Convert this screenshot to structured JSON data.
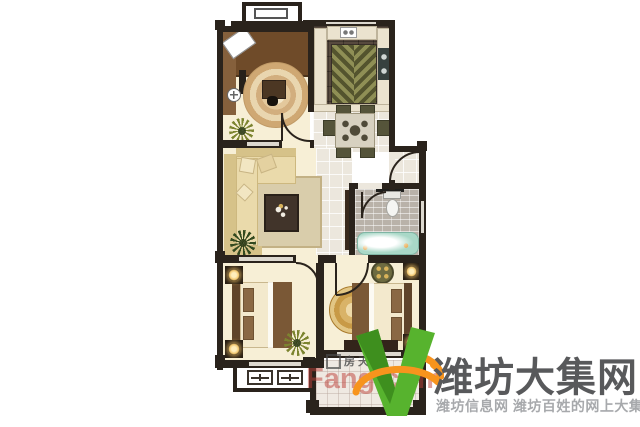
{
  "page": {
    "background": "#ffffff",
    "width": 640,
    "height": 427
  },
  "floorplan": {
    "type": "apartment-floor-plan",
    "rooms": [
      {
        "name": "study",
        "furniture": [
          "wardrobe-desk",
          "drafting-board",
          "round-rug",
          "computer-desk",
          "potted-plant"
        ]
      },
      {
        "name": "kitchen",
        "furniture": [
          "counters",
          "stove",
          "sink",
          "chevron-rug"
        ]
      },
      {
        "name": "dining-area",
        "furniture": [
          "dining-table",
          "dining-chairs"
        ]
      },
      {
        "name": "entry-hall",
        "furniture": []
      },
      {
        "name": "living-room",
        "furniture": [
          "corner-sofa",
          "coffee-table",
          "area-rug",
          "tv-cabinet",
          "potted-plant"
        ]
      },
      {
        "name": "bathroom",
        "furniture": [
          "toilet",
          "bathtub",
          "cabinet"
        ]
      },
      {
        "name": "bedroom-left",
        "furniture": [
          "double-bed",
          "nightstands",
          "lamps",
          "potted-plant"
        ]
      },
      {
        "name": "bedroom-master",
        "furniture": [
          "double-bed",
          "nightstands",
          "lamps",
          "gold-round-rug",
          "round-table",
          "dresser"
        ]
      },
      {
        "name": "balcony-top"
      },
      {
        "name": "balcony-bottom-left"
      },
      {
        "name": "balcony-bottom-right"
      }
    ]
  },
  "watermarks": {
    "fang": {
      "cn": "房天下",
      "en": "Fang.com"
    },
    "brand": {
      "logo": "v-leaf-swoosh-logo",
      "name": "潍坊大集网",
      "tagline": "潍坊信息网 潍坊百姓的网上大集"
    }
  },
  "palette": {
    "wall": "#2a231c",
    "floor_cream": "#f7efd6",
    "hall_tile": "#ece7dd",
    "kitchen_floor": "#57493e",
    "counter": "#ebe3cf",
    "chevron_olive": "#8f8f55",
    "chevron_dark": "#54542e",
    "wood_dark": "#6f4b29",
    "wood_mid": "#85603c",
    "rug_beige": "#d9cdab",
    "rug_border": "#c3b185",
    "sofa_beige": "#eadaab",
    "sofa_shade": "#d6c289",
    "table_wood": "#41342a",
    "tile_gray": "#b9b2a9",
    "tub_teal": "#a9d8c7",
    "olive_chair": "#55543a",
    "plant_olive": "#7c842f",
    "plant_dark": "#32491f",
    "bed_cream": "#f3e9cd",
    "bed_border": "#c9b78e",
    "blanket_brown": "#7a5836",
    "pillow_brown": "#8a6844",
    "night_dark": "#251c13",
    "lamp_glow": "#f2c66d",
    "window_gray": "#dcd8cf",
    "fang_red": "#bc4038",
    "brand_text": "#58595b",
    "brand_sub": "#a7a9ac",
    "logo_green": "#57b32e",
    "logo_green_dark": "#3e8f1e",
    "logo_orange": "#f7941d"
  }
}
